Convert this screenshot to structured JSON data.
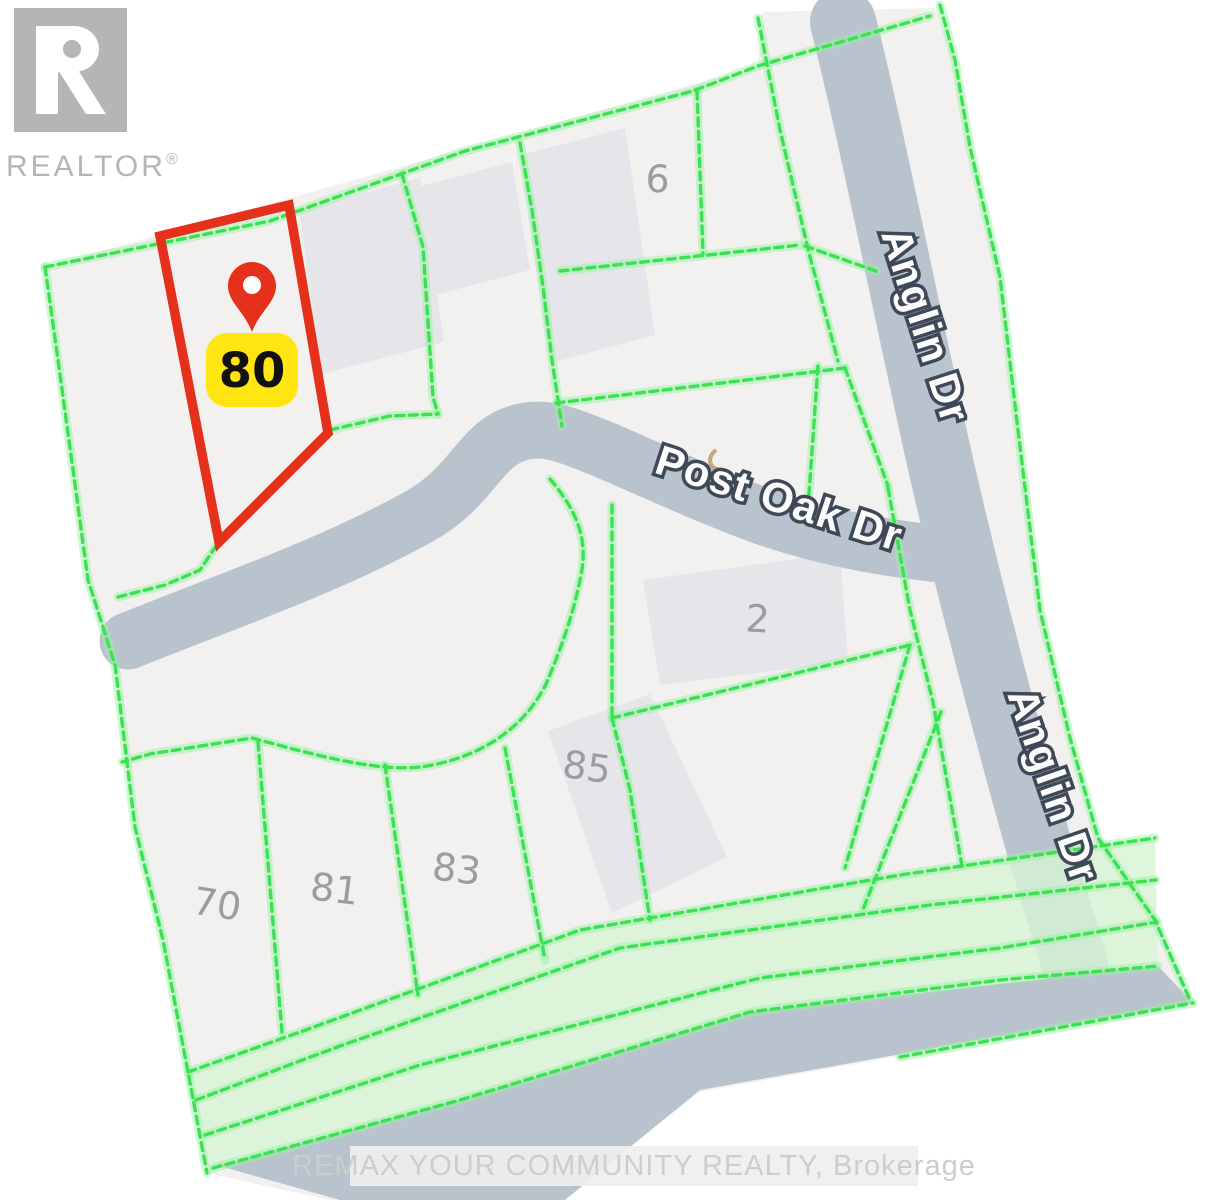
{
  "branding": {
    "logo_text": "REALTOR",
    "registered_mark": "®"
  },
  "map": {
    "streets": [
      {
        "name": "Anglin Dr"
      },
      {
        "name": "Post Oak Dr"
      },
      {
        "name": "Anglin Dr"
      }
    ],
    "highlighted_lot": {
      "number": "80"
    },
    "lot_numbers": [
      {
        "value": "6"
      },
      {
        "value": "2"
      },
      {
        "value": "85"
      },
      {
        "value": "83"
      },
      {
        "value": "81"
      },
      {
        "value": "70"
      }
    ],
    "colors": {
      "parcel_line": "#3CE153",
      "highlight_outline": "#E5301B",
      "marker_badge": "#FFE613",
      "road": "#B9C3CD",
      "greenbelt": "#D7F4D5"
    }
  },
  "watermark": {
    "text": "REMAX YOUR COMMUNITY REALTY, Brokerage"
  }
}
